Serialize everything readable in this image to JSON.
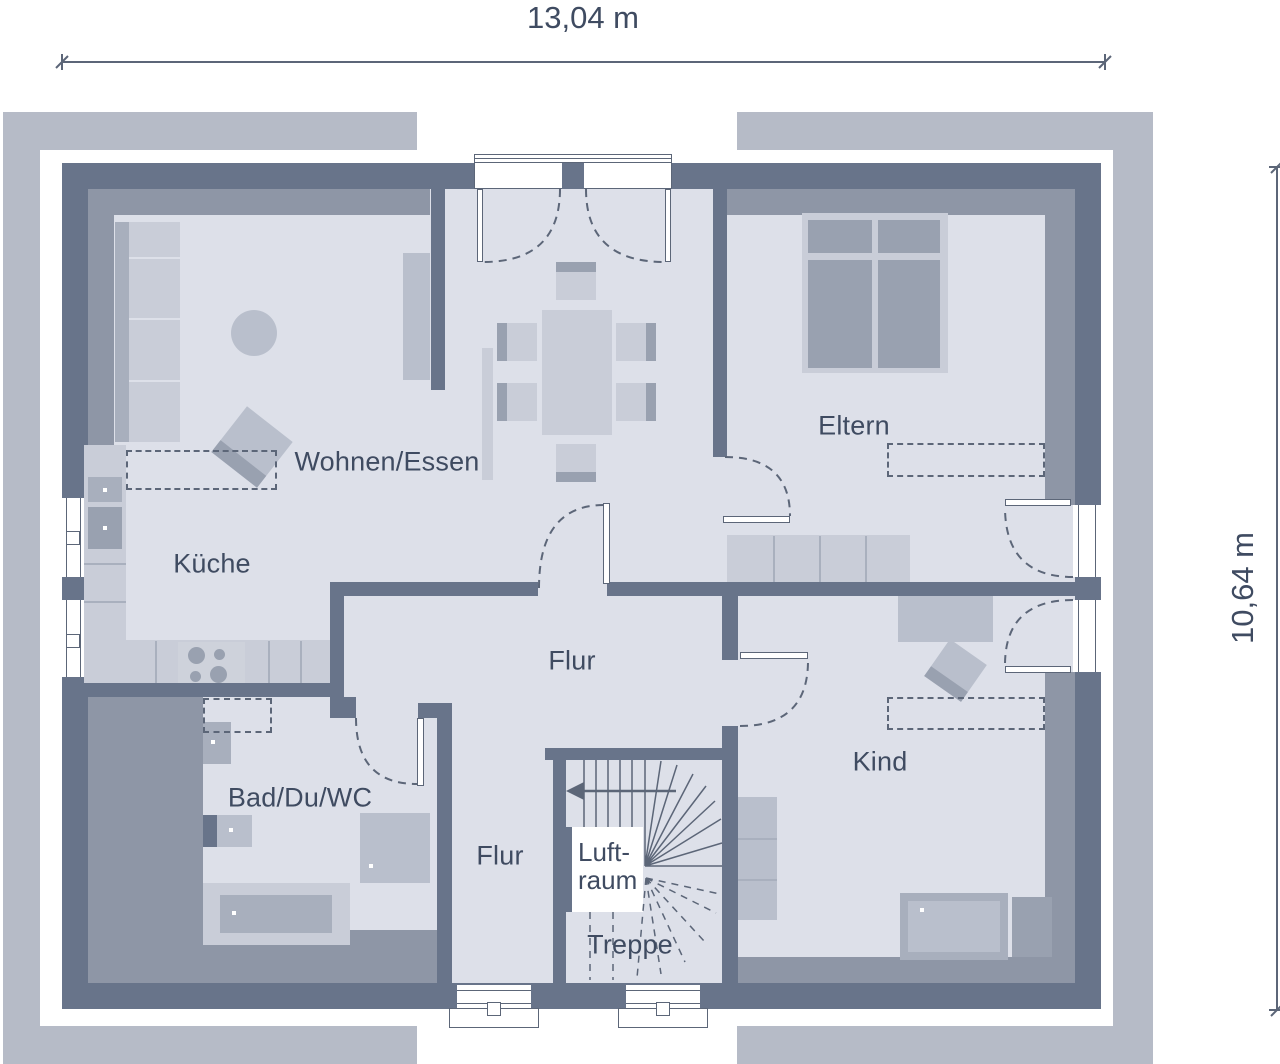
{
  "plan": {
    "title": "floor-plan",
    "dimension_width": "13,04 m",
    "dimension_height": "10,64 m",
    "rooms": {
      "living": "Wohnen/Essen",
      "kitchen": "Küche",
      "parents": "Eltern",
      "hall_upper": "Flur",
      "hall_lower": "Flur",
      "bath": "Bad/Du/WC",
      "child": "Kind",
      "airspace_line1": "Luft-",
      "airspace_line2": "raum",
      "stairs": "Treppe"
    },
    "colors": {
      "wall": "#68748a",
      "band": "#8e96a6",
      "floor": "#dde0e9",
      "outer_band": "#b6bbc7",
      "furniture_light": "#c9cdd8",
      "furniture_mid": "#b9bfcc",
      "furniture_dark": "#a8afbd",
      "furniture_darker": "#99a1b0",
      "line": "#5c6678",
      "text": "#3f4b61"
    }
  }
}
